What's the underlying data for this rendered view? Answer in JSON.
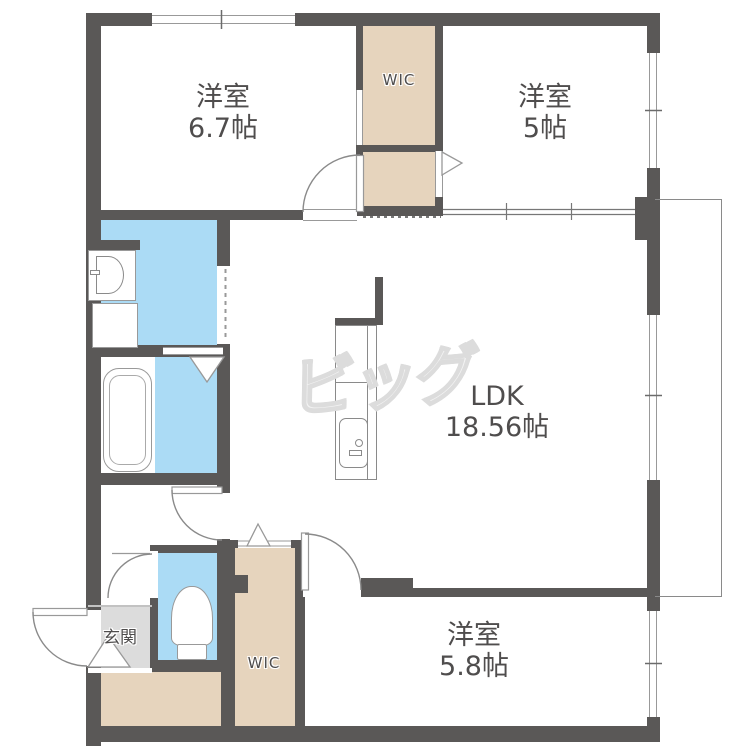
{
  "document": {
    "type": "floor-plan"
  },
  "rooms": {
    "bedroom1": {
      "label": "洋室",
      "size": "6.7帖"
    },
    "bedroom2": {
      "label": "洋室",
      "size": "5帖"
    },
    "ldk": {
      "label": "LDK",
      "size": "18.56帖"
    },
    "bedroom3": {
      "label": "洋室",
      "size": "5.8帖"
    },
    "wic1": {
      "label": "WIC"
    },
    "wic2": {
      "label": "WIC"
    },
    "genkan": {
      "label": "玄関"
    }
  },
  "watermark": {
    "text": "ビッグ"
  },
  "colors": {
    "wall": "#5a5857",
    "closet": "#e6d4bd",
    "wet": "#abdbf5",
    "entry": "#dcdcdc",
    "line": "#999999",
    "text": "#4f4d4d",
    "watermark": "#dcdcdc"
  }
}
